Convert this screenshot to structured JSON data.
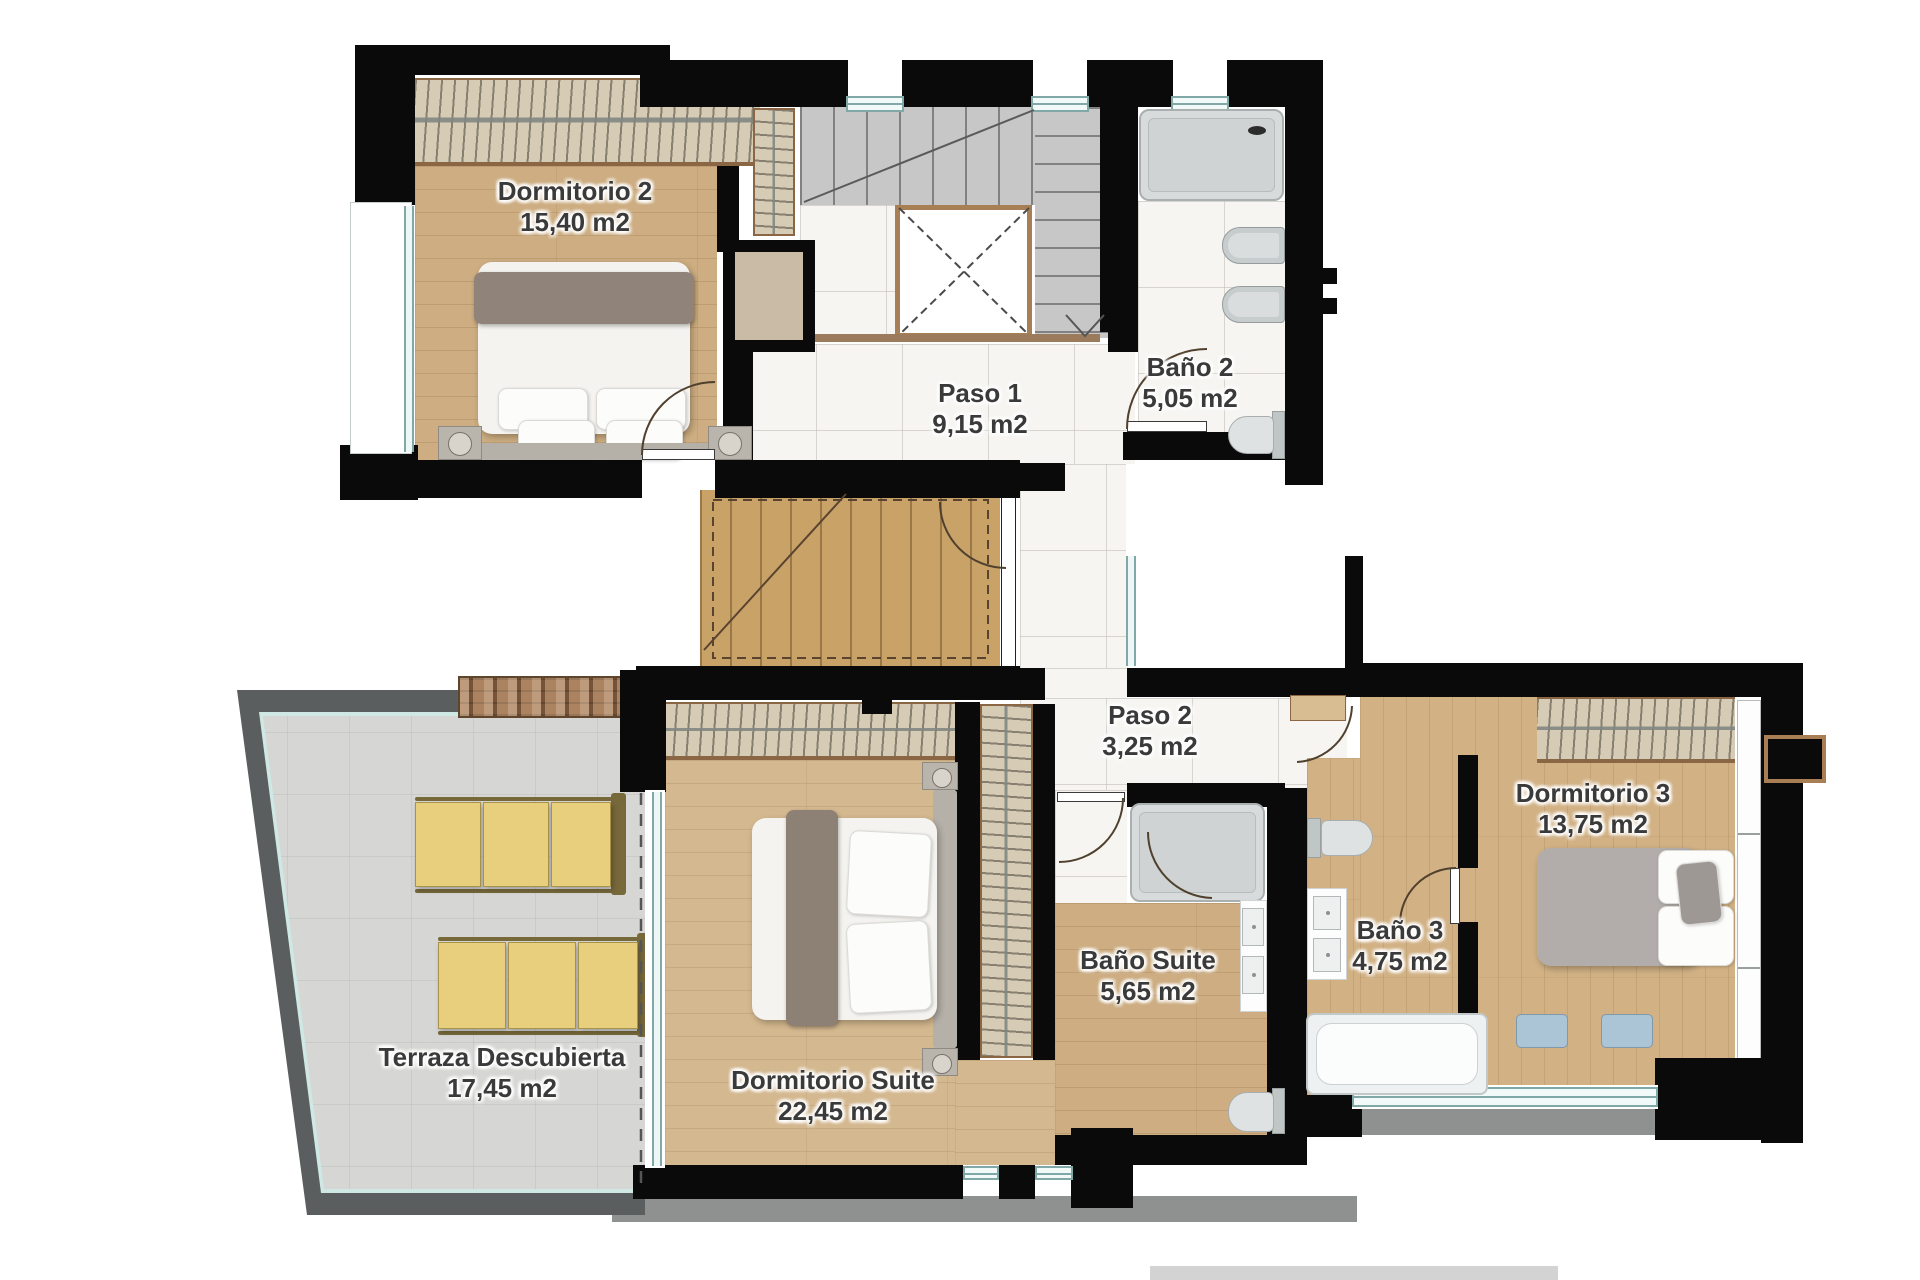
{
  "rooms": [
    {
      "id": "dormitorio-2",
      "name": "Dormitorio 2",
      "area": "15,40 m2"
    },
    {
      "id": "paso-1",
      "name": "Paso 1",
      "area": "9,15 m2"
    },
    {
      "id": "bano-2",
      "name": "Baño 2",
      "area": "5,05 m2"
    },
    {
      "id": "paso-2",
      "name": "Paso 2",
      "area": "3,25 m2"
    },
    {
      "id": "dormitorio-3",
      "name": "Dormitorio 3",
      "area": "13,75 m2"
    },
    {
      "id": "bano-suite",
      "name": "Baño Suite",
      "area": "5,65 m2"
    },
    {
      "id": "bano-3",
      "name": "Baño 3",
      "area": "4,75 m2"
    },
    {
      "id": "terraza",
      "name": "Terraza Descubierta",
      "area": "17,45 m2"
    },
    {
      "id": "dormitorio-suite",
      "name": "Dormitorio Suite",
      "area": "22,45 m2"
    }
  ],
  "colors": {
    "wall": "#0a0a0a",
    "wood_floor": "#cdad81",
    "wood_floor_light": "#d4b88f",
    "marble_floor": "#f6f5f2",
    "stair_tile": "#c7c7c7",
    "terrace_tile": "#d6d6d4",
    "terrace_parapet": "#5a5e5e",
    "window_glass": "#7fa8a6",
    "lounger_yellow": "#e7cf7d",
    "fixture_gray": "#c7cccd",
    "label_text": "#3a3a3a"
  }
}
